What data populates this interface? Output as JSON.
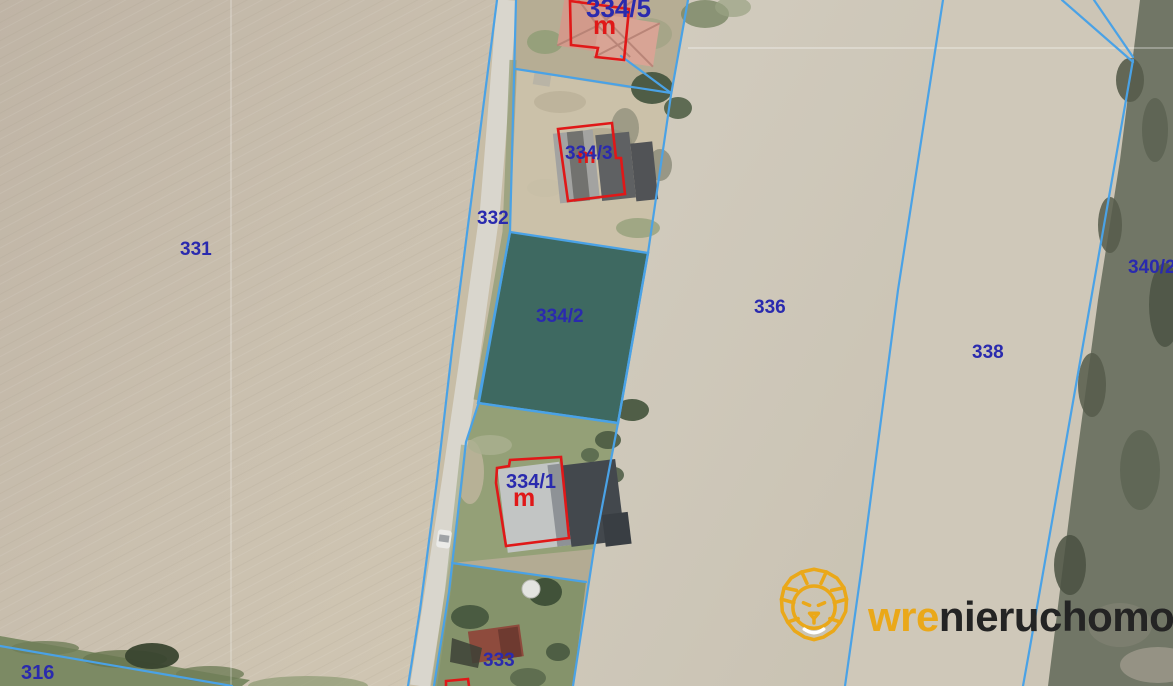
{
  "map": {
    "type": "cadastral-aerial-map",
    "highlighted_parcel": "334/2",
    "building_marker": "m",
    "labels": {
      "p331": "331",
      "p332": "332",
      "p316": "316",
      "p333": "333",
      "p334_1": "334/1",
      "p334_2": "334/2",
      "p334_3": "334/3",
      "p334_5": "334/5",
      "p336": "336",
      "p338": "338",
      "p340": "340/2"
    },
    "colors": {
      "parcel_boundary_line": "#4aa2e6",
      "parcel_number_text": "#2a2aae",
      "building_outline": "#e01818",
      "highlight_fill": "rgba(16,82,86,0.52)"
    }
  },
  "watermark": {
    "brand_prefix": "wre",
    "brand_suffix": "nieruchomości",
    "lion_color": "#eaa819",
    "text_color": "#242424"
  }
}
